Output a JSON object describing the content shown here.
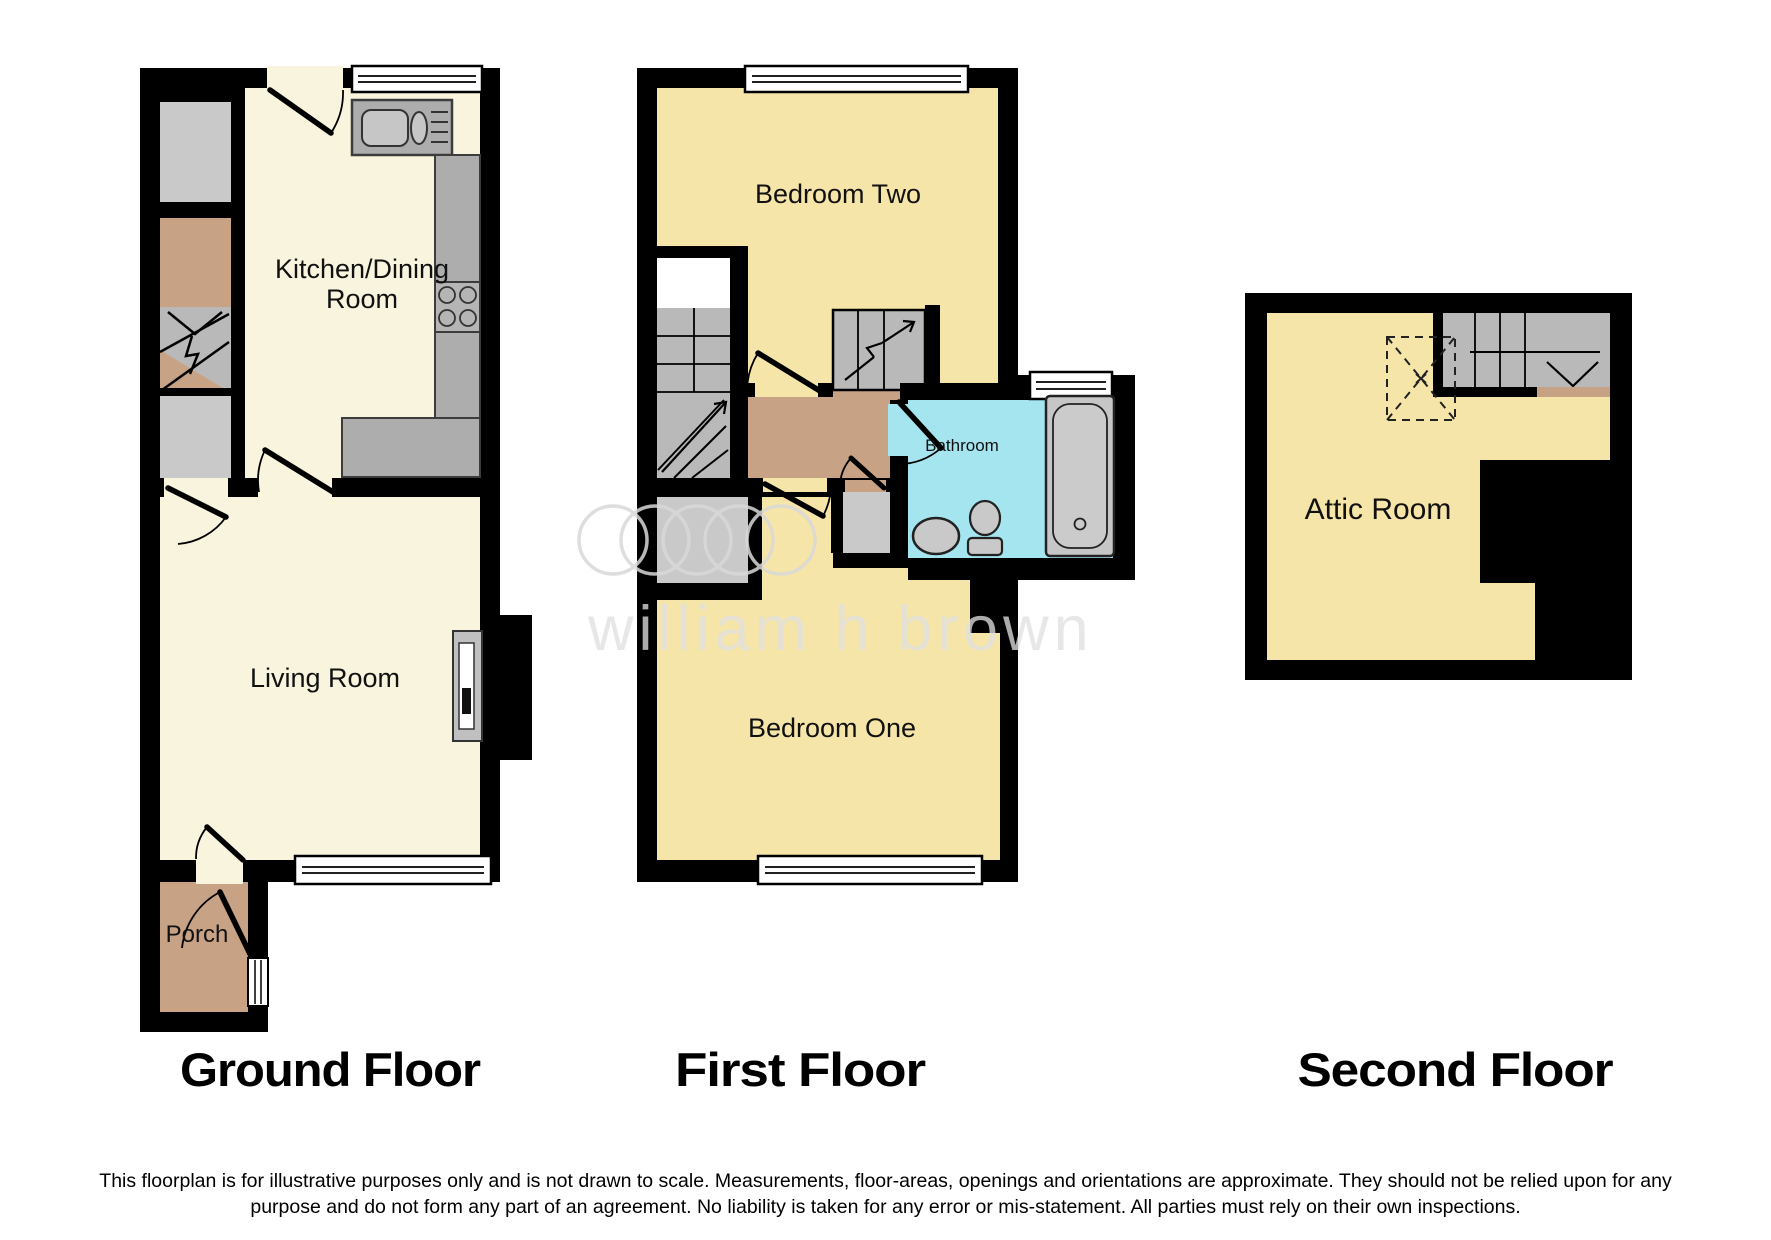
{
  "watermark": {
    "text": "william h brown"
  },
  "floors": [
    {
      "label": "Ground Floor",
      "rooms": {
        "kitchen": {
          "label_lines": [
            "Kitchen/Dining",
            "Room"
          ]
        },
        "living": {
          "label": "Living Room"
        },
        "porch": {
          "label": "Porch"
        }
      }
    },
    {
      "label": "First Floor",
      "rooms": {
        "bedroom_two": {
          "label": "Bedroom Two"
        },
        "bathroom": {
          "label": "Bathroom"
        },
        "bedroom_one": {
          "label": "Bedroom One"
        }
      }
    },
    {
      "label": "Second Floor",
      "rooms": {
        "attic": {
          "label": "Attic Room"
        }
      }
    }
  ],
  "disclaimer": {
    "line1": "This floorplan is for illustrative purposes only and is not drawn to scale. Measurements, floor-areas, openings and orientations are approximate. They should not be relied upon for any",
    "line2": "purpose and do not form any part of an agreement. No liability is taken for any error or mis-statement. All parties must rely on their own inspections."
  },
  "colors": {
    "wall": "#000000",
    "floor_cream": "#f8f4de",
    "floor_yellow": "#f6e5a8",
    "floor_tan": "#c7a285",
    "bathroom_blue": "#a5e5f0",
    "stairs_gray": "#b9b9b9",
    "storage_gray": "#c9c9c9",
    "counter_gray": "#adadad",
    "fixture_gray": "#c9c9c9",
    "watermark_gray": "#e0e0e0"
  }
}
